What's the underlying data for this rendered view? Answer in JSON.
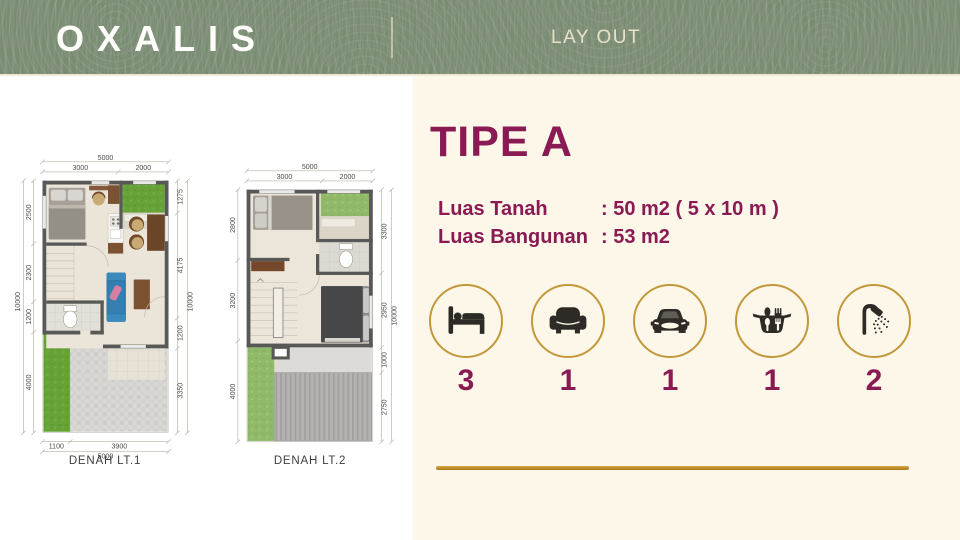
{
  "header": {
    "brand": "OXALIS",
    "page_title": "LAY OUT"
  },
  "panel": {
    "title": "TIPE A",
    "specs": [
      {
        "label": "Luas Tanah",
        "value": ": 50 m2 ( 5 x 10 m )"
      },
      {
        "label": "Luas Bangunan",
        "value": ": 53 m2"
      }
    ],
    "features": [
      {
        "icon": "bed-icon",
        "count": "3"
      },
      {
        "icon": "sofa-icon",
        "count": "1"
      },
      {
        "icon": "car-icon",
        "count": "1"
      },
      {
        "icon": "kitchen-icon",
        "count": "1"
      },
      {
        "icon": "shower-icon",
        "count": "2"
      }
    ]
  },
  "plans": [
    {
      "label": "DENAH LT.1",
      "top": {
        "total": "5000",
        "segs": [
          "3000",
          "2000"
        ]
      },
      "bottom": {
        "total": "5000",
        "segs": [
          "1100",
          "3900"
        ]
      },
      "left": {
        "total": "10000",
        "segs": [
          "2500",
          "2300",
          "1200",
          "4000"
        ]
      },
      "right": {
        "total": "10000",
        "segs": [
          "1275",
          "4175",
          "1200",
          "3350"
        ]
      }
    },
    {
      "label": "DENAH LT.2",
      "top": {
        "total": "5000",
        "segs": [
          "3000",
          "2000"
        ]
      },
      "left": {
        "segs": [
          "2800",
          "3200",
          "4000"
        ]
      },
      "right": {
        "total": "10000",
        "segs": [
          "3300",
          "2950",
          "1000",
          "2750"
        ]
      }
    }
  ],
  "colors": {
    "header_green": "#7b8c75",
    "cream": "#fcf7e8",
    "magenta": "#8a1a54",
    "gold": "#c3983b",
    "icon_dark": "#2e2b27"
  }
}
